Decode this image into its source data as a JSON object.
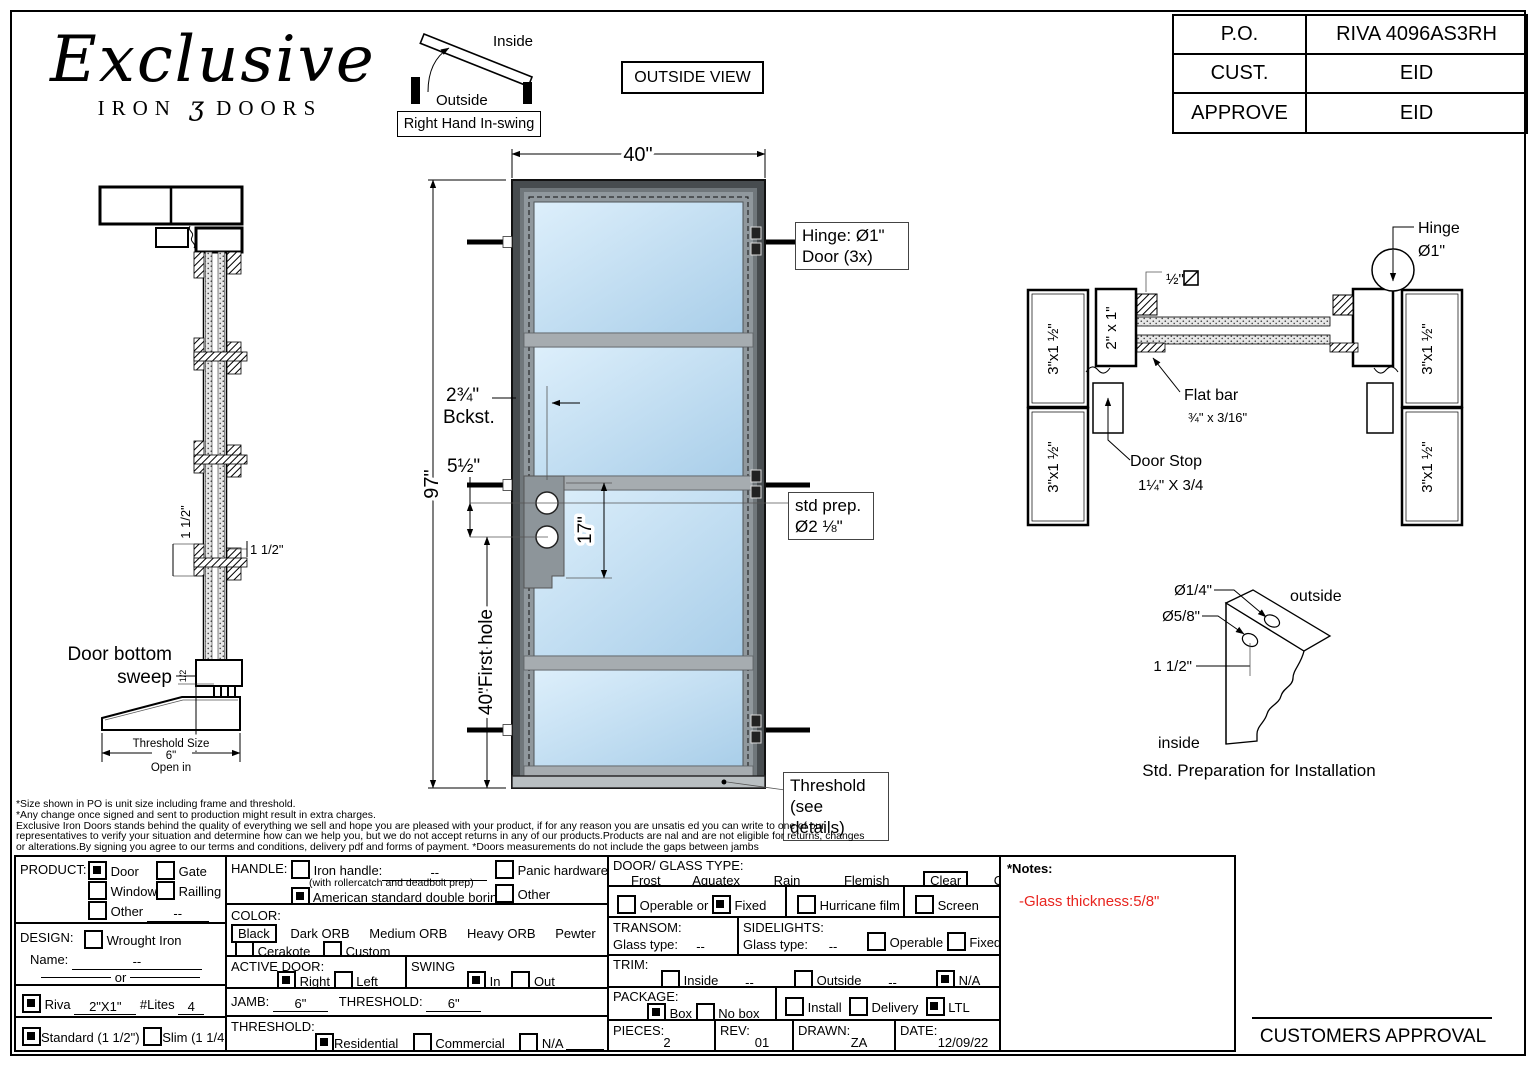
{
  "header": {
    "logo_script": "Exclusive",
    "logo_iron": "IRON",
    "logo_ornament": "ʒ",
    "logo_doors": "DOORS",
    "po_table": {
      "rows": [
        {
          "k": "P.O.",
          "v": "RIVA 4096AS3RH"
        },
        {
          "k": "CUST.",
          "v": "EID"
        },
        {
          "k": "APPROVE",
          "v": "EID"
        }
      ]
    },
    "view_label": "OUTSIDE VIEW"
  },
  "drawing": {
    "swing": {
      "inside": "Inside",
      "outside": "Outside",
      "tag": "Right Hand In-swing"
    },
    "elev": {
      "dim_width": "40\"",
      "dim_height": "97\"",
      "dim_first_hole": "40\"First hole",
      "backset1": "2¾\"",
      "backset2": "Bckst.",
      "lock_top": "5½\"",
      "holes": "17\"",
      "hinge1": "Hinge: Ø1\"",
      "hinge2": "Door (3x)",
      "prep1": "std prep.",
      "prep2": "Ø2 ⅛\"",
      "thr1": "Threshold",
      "thr2": "(see details)"
    },
    "sect": {
      "door_bottom1": "Door bottom",
      "door_bottom2": "sweep",
      "half": "1/2",
      "dim_v": "1 1/2\"",
      "dim_h": "1 1/2\"",
      "ts1": "Threshold Size",
      "ts2": "6\"",
      "ts3": "Open in"
    },
    "cross": {
      "jamb": "3\"x1 ½\"",
      "tube": "2\" x 1\"",
      "square_bar": "½\"",
      "flat1": "Flat bar",
      "flat2": "¾\" x 3/16\"",
      "stop1": "Door Stop",
      "stop2": "1¼\" X 3/4",
      "hinge1": "Hinge",
      "hinge2": "Ø1\""
    },
    "install": {
      "hole_small": "Ø1/4\"",
      "hole_large": "Ø5/8\"",
      "offset": "1 1/2\"",
      "outside": "outside",
      "inside": "inside",
      "caption": "Std. Preparation for Installation"
    }
  },
  "disclaimer": {
    "l1": "*Size shown in PO is unit size including frame and threshold.",
    "l2": "*Any change once signed and sent to production might result in extra charges.",
    "l3": "Exclusive Iron Doors stands behind the quality of everything we sell and hope you are pleased with your product, if for any reason you are unsatis   ed you can write to one of our",
    "l4": "representatives to verify your situation and determine how can we help you, but we do not accept returns in any of our products.Products are     nal and are not eligible for returns, changes",
    "l5": "or alterations.By signing you agree to our terms and conditions, delivery pdf and forms of payment. *Doors measurements do not include the gaps between jambs"
  },
  "form": {
    "product": {
      "label": "PRODUCT:",
      "door": {
        "t": "Door",
        "c": true
      },
      "gate": {
        "t": "Gate",
        "c": false
      },
      "window": {
        "t": "Window",
        "c": false
      },
      "railing": {
        "t": "Railling",
        "c": false
      },
      "other": {
        "t": "Other",
        "c": false,
        "v": "--"
      }
    },
    "design": {
      "label": "DESIGN:",
      "wi": {
        "t": "Wrought Iron",
        "c": false
      },
      "name_label": "Name:",
      "name_value": "--",
      "or_label": "or"
    },
    "riva": {
      "c": true,
      "t": "Riva",
      "size": "2\"X1\"",
      "lites_label": "#Lites",
      "lites": "4"
    },
    "std": {
      "standard": {
        "t": "Standard (1 1/2\")",
        "c": true
      },
      "slim": {
        "t": "Slim (1 1/4\")",
        "c": false
      }
    },
    "handle": {
      "label": "HANDLE:",
      "iron": {
        "t": "Iron handle:",
        "v": "--",
        "c": false
      },
      "sub": "(with rollercatch and deadbolt prep)",
      "asdb": {
        "t": "American standard double boring",
        "c": true
      },
      "panic": {
        "t": "Panic hardware",
        "c": false
      },
      "other": {
        "t": "Other",
        "c": false
      }
    },
    "color": {
      "label": "COLOR:",
      "selected": "Black",
      "opts": [
        "Dark ORB",
        "Medium ORB",
        "Heavy ORB",
        "Pewter",
        "Antique gold"
      ],
      "cerakote": {
        "t": "Cerakote",
        "c": false
      },
      "custom": {
        "t": "Custom",
        "c": false
      }
    },
    "active": {
      "label": "ACTIVE DOOR:",
      "right": {
        "t": "Right",
        "c": true
      },
      "left": {
        "t": "Left",
        "c": false
      }
    },
    "swing": {
      "label": "SWING",
      "in": {
        "t": "In",
        "c": true
      },
      "out": {
        "t": "Out",
        "c": false
      }
    },
    "jamb": {
      "label": "JAMB:",
      "value": "6\"",
      "t_label": "THRESHOLD:",
      "t_value": "6\""
    },
    "threshold": {
      "label": "THRESHOLD:",
      "res": {
        "t": "Residential",
        "c": true
      },
      "com": {
        "t": "Commercial",
        "c": false
      },
      "na": {
        "t": "N/A",
        "c": false
      }
    },
    "glass": {
      "label": "DOOR/ GLASS TYPE:",
      "o1": "Frost",
      "o2": "Aquatex",
      "o3": "Rain",
      "o4": "Flemish",
      "selected": "Clear",
      "o6": "Other"
    },
    "mode": {
      "operable": {
        "t": "Operable",
        "c": false
      },
      "or": "or",
      "fixed": {
        "t": "Fixed",
        "c": true
      },
      "film": {
        "t": "Hurricane film",
        "c": false
      },
      "screen": {
        "t": "Screen",
        "c": false
      }
    },
    "transom": {
      "label": "TRANSOM:",
      "gt": "Glass type:",
      "v": "--"
    },
    "sidelights": {
      "label": "SIDELIGHTS:",
      "gt": "Glass type:",
      "v": "--",
      "operable": {
        "t": "Operable",
        "c": false
      },
      "fixed": {
        "t": "Fixed",
        "c": false
      }
    },
    "trim": {
      "label": "TRIM:",
      "inside": {
        "t": "Inside",
        "c": false,
        "v": "--"
      },
      "outside": {
        "t": "Outside",
        "c": false,
        "v": "--"
      },
      "na": {
        "t": "N/A",
        "c": true
      }
    },
    "pkg": {
      "label": "PACKAGE:",
      "box": {
        "t": "Box",
        "c": true
      },
      "nobox": {
        "t": "No box",
        "c": false
      },
      "install": {
        "t": "Install",
        "c": false
      },
      "delivery": {
        "t": "Delivery",
        "c": false
      },
      "ltl": {
        "t": "LTL",
        "c": true
      }
    },
    "meta": {
      "pieces_label": "PIECES:",
      "pieces": "2",
      "rev_label": "REV:",
      "rev": "01",
      "drawn_label": "DRAWN:",
      "drawn": "ZA",
      "date_label": "DATE:",
      "date": "12/09/22"
    }
  },
  "notes": {
    "title": "*Notes:",
    "text": "-Glass thickness:5/8\"",
    "color": "#e8251f"
  },
  "approval": {
    "label": "CUSTOMERS APPROVAL"
  }
}
